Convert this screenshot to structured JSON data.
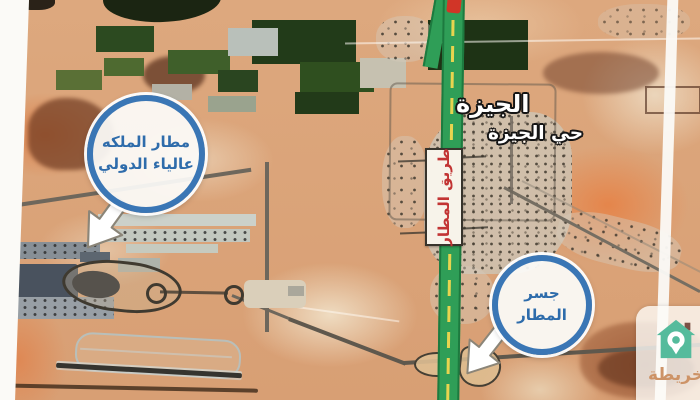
{
  "labels": {
    "city": "الجيزة",
    "district": "حي الجيزة"
  },
  "road_sign": {
    "text": "طريق المطار"
  },
  "callouts": {
    "airport": {
      "line1": "مطار الملكه",
      "line2": "عالياء الدولي"
    },
    "bridge": {
      "line1": "جسر",
      "line2": "المطار"
    }
  },
  "watermark": {
    "brand": "خريطة"
  },
  "icons": {
    "airport_arrow": "white-arrow-down-left",
    "bridge_arrow": "white-arrow-down-left",
    "brand_logo": "house-with-map-pin"
  },
  "colors": {
    "sand_base": "#dca87e",
    "highway_green": "#2f9e57",
    "highway_line_yellow": "#e8d44f",
    "callout_border_blue": "#3a76b5",
    "callout_text_blue": "#2e6cab",
    "sign_text_red": "#c23434",
    "logo_teal": "#55bb9c",
    "logo_text_orange": "#cd9367"
  }
}
